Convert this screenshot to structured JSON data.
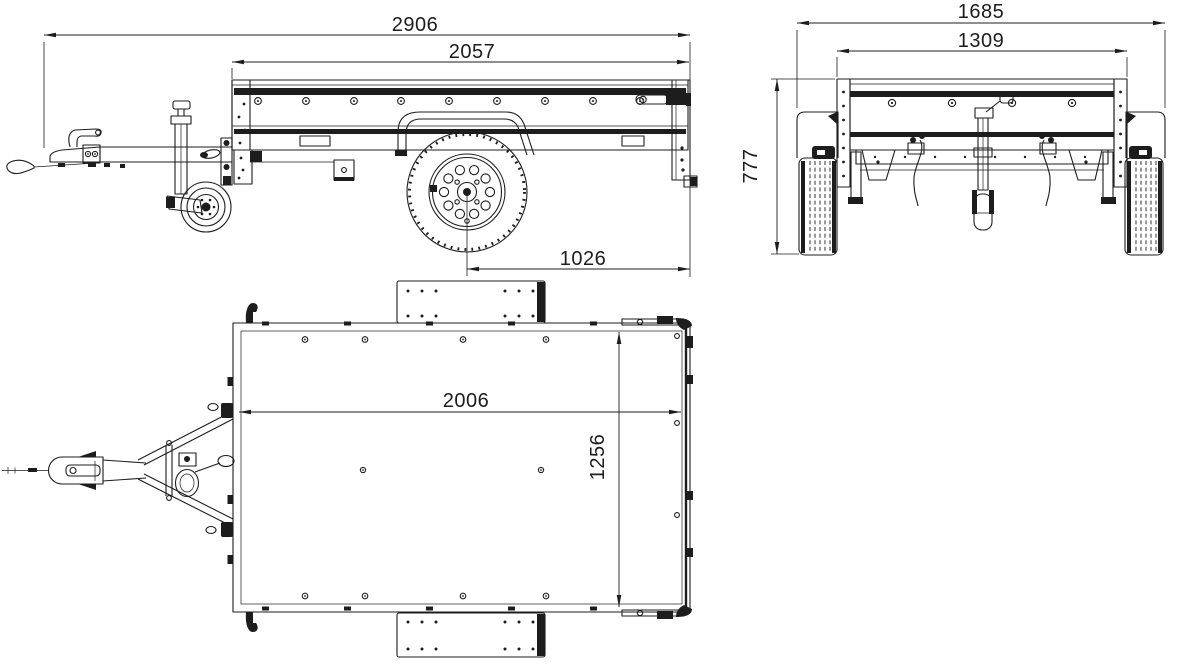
{
  "drawing": {
    "type": "trailer-technical-drawing",
    "colors": {
      "ink": "#1d1d1d",
      "background": "#ffffff"
    }
  },
  "views": {
    "side": {
      "name": "side-view",
      "dimensions": {
        "overall_length": "2906",
        "box_length": "2057",
        "axle_to_rear": "1026"
      }
    },
    "rear": {
      "name": "rear-view",
      "dimensions": {
        "overall_width": "1685",
        "box_width": "1309",
        "overall_height": "777"
      }
    },
    "top": {
      "name": "top-view",
      "dimensions": {
        "inner_length": "2006",
        "inner_width": "1256"
      }
    }
  }
}
